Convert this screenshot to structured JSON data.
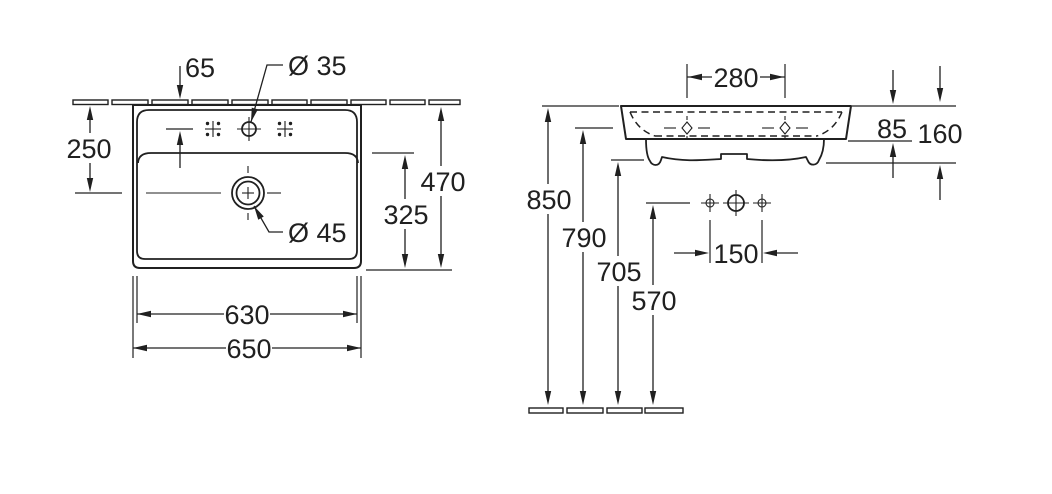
{
  "colors": {
    "ink": "#202020",
    "background": "#ffffff"
  },
  "top_view": {
    "hole_setback": "65",
    "faucet_hole_dia": "Ø 35",
    "drain_setback": "250",
    "overall_depth": "470",
    "bowl_depth": "325",
    "drain_dia": "Ø 45",
    "inner_width": "630",
    "overall_width": "650"
  },
  "front_view": {
    "upper_hole_spacing": "280",
    "rim_height": "85",
    "body_height": "160",
    "rim_floor_height": "850",
    "upper_holes_floor_height": "790",
    "body_bottom_floor_height": "705",
    "lower_holes_floor_height": "570",
    "lower_hole_spacing": "150"
  }
}
